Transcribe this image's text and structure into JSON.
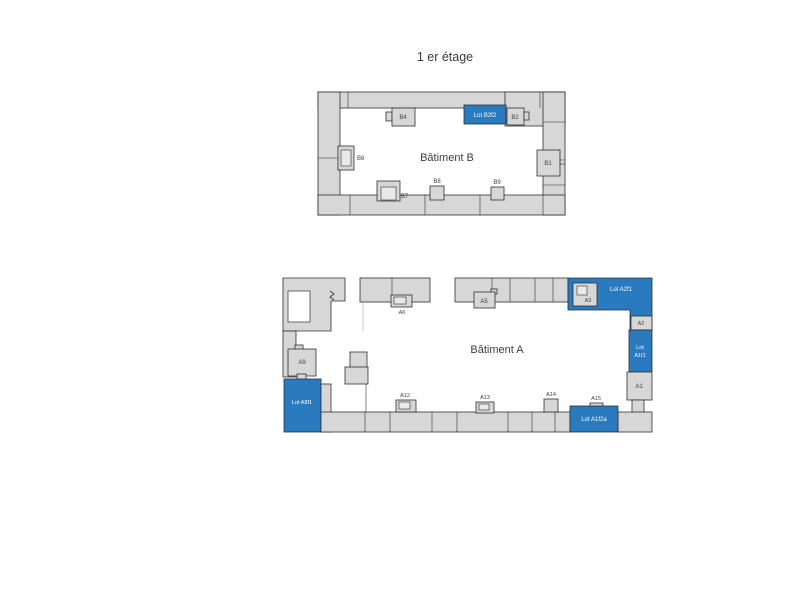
{
  "title": "1 er étage",
  "colors": {
    "wall": "#d7d7d7",
    "wall_outline": "#2f2f2f",
    "lot": "#2a7abf",
    "label": "#3d3d3d",
    "lot_label": "#ffffff",
    "background": "#ffffff"
  },
  "building_b": {
    "name": "Bâtiment B",
    "units": {
      "b1": "B1",
      "b2": "B2",
      "b4": "B4",
      "b6": "B6",
      "b7": "B7",
      "b8": "B8",
      "b9": "B9"
    },
    "lots": {
      "b2f2": "Lot B2f2"
    }
  },
  "building_a": {
    "name": "Bâtiment A",
    "units": {
      "a1": "A1",
      "a2": "A2",
      "a3": "A3",
      "a5": "A5",
      "a6": "A6",
      "a9": "A9",
      "a12": "A12",
      "a13": "A13",
      "a14": "A14",
      "a15": "A15"
    },
    "lots": {
      "a2f1": "Lot A2f1",
      "a1f1_line1": "Lot",
      "a1f1_line2": "A1f1",
      "a1f2a": "Lot A1f2a",
      "a8f1": "Lot A8f1"
    }
  }
}
